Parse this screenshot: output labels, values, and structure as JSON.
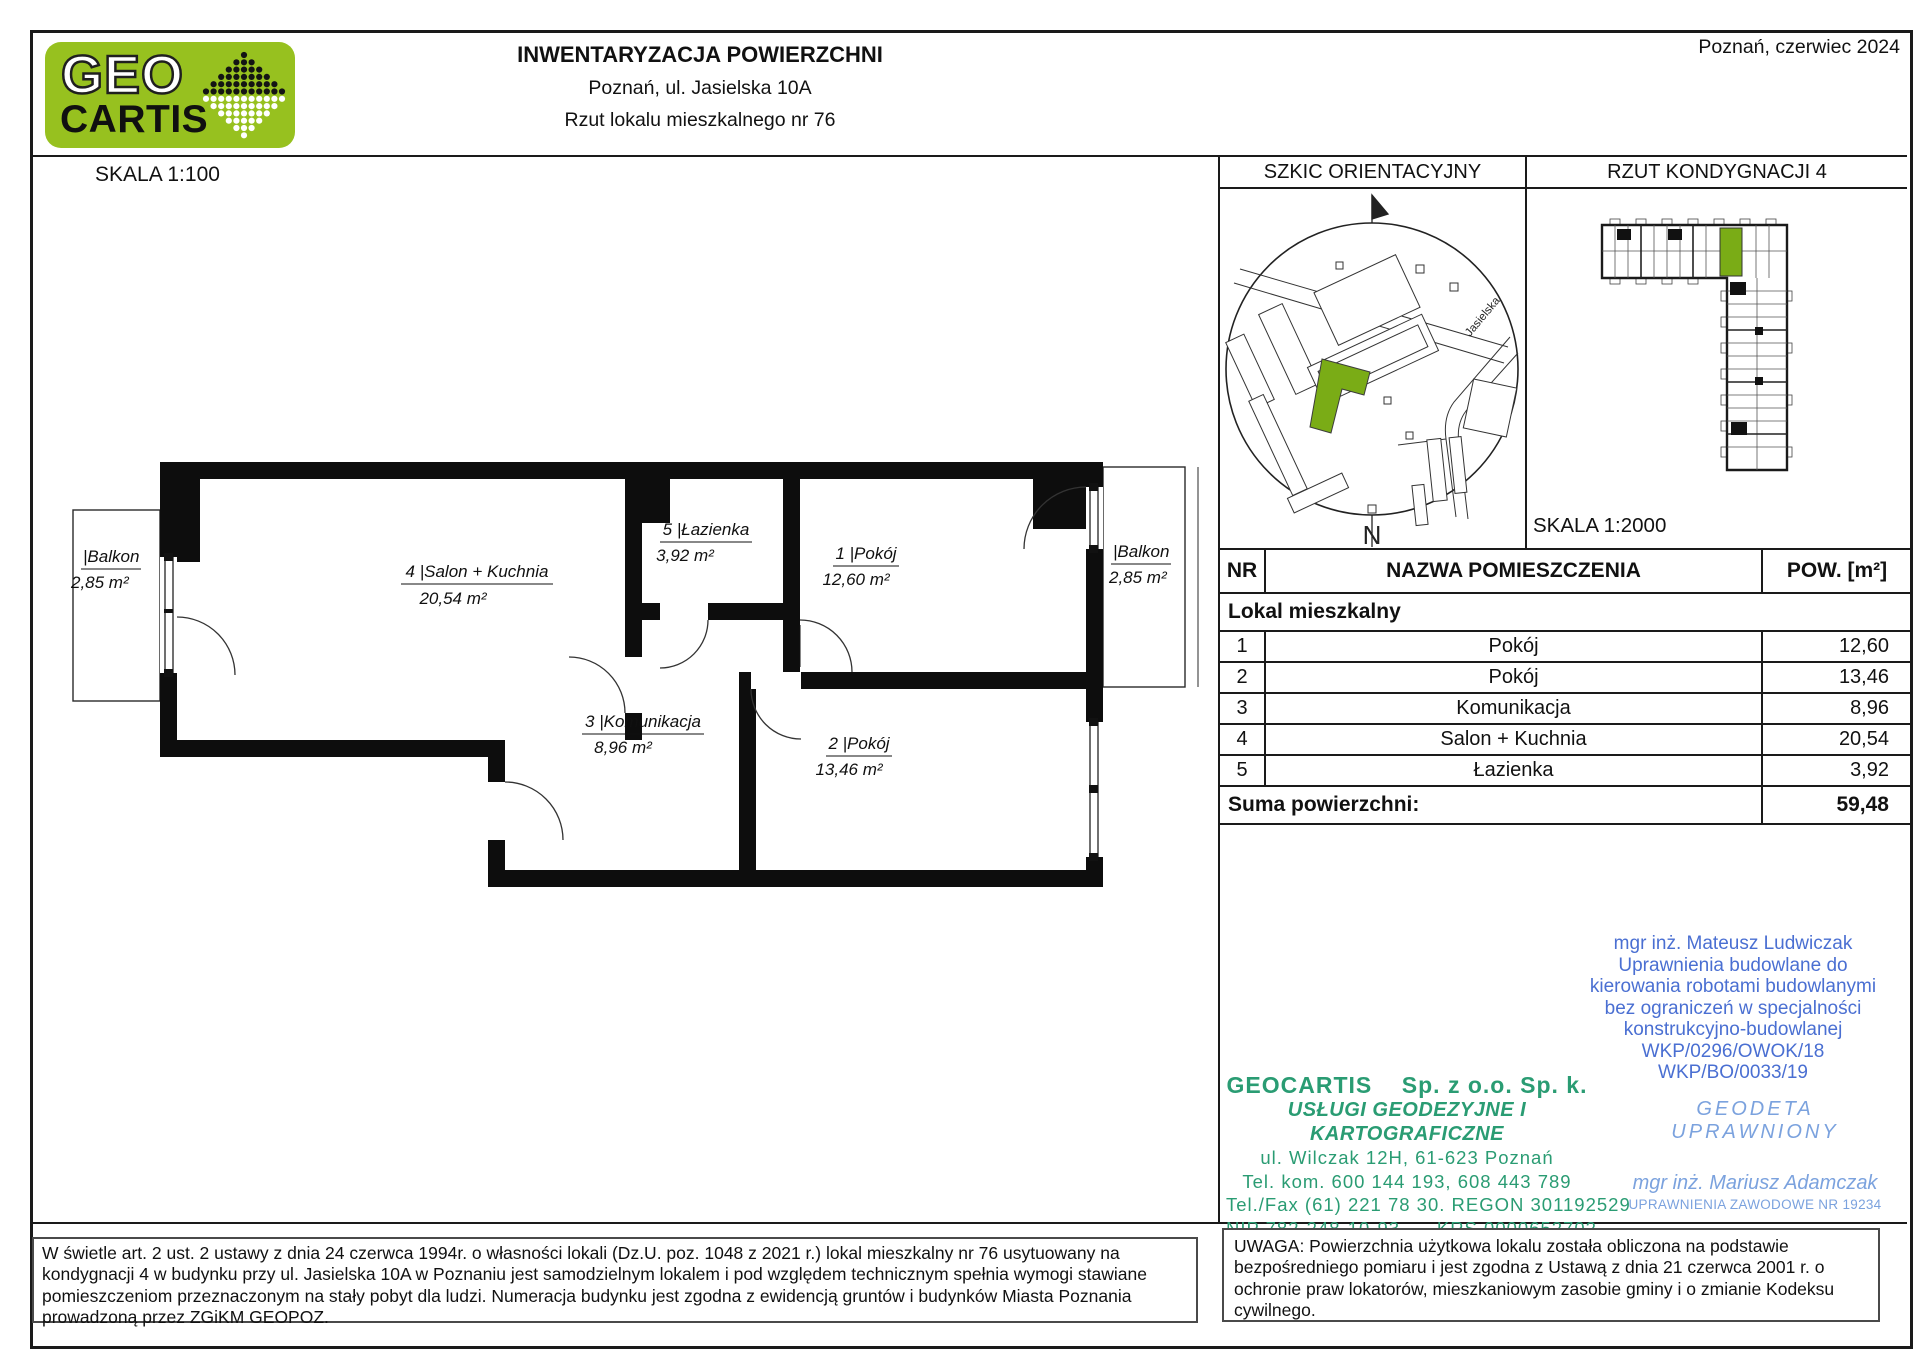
{
  "header": {
    "logo_top": "GEO",
    "logo_bottom": "CARTIS",
    "title": "INWENTARYZACJA POWIERZCHNI",
    "subtitle": "Poznań, ul. Jasielska 10A",
    "doc_type": "Rzut lokalu mieszkalnego nr 76",
    "date": "Poznań, czerwiec 2024"
  },
  "plan": {
    "scale_label": "SKALA 1:100",
    "rooms": {
      "salon": {
        "label": "4 |Salon + Kuchnia",
        "area": "20,54 m²"
      },
      "lazienka": {
        "label": "5 |Łazienka",
        "area": "3,92 m²"
      },
      "pokoj1": {
        "label": "1 |Pokój",
        "area": "12,60 m²"
      },
      "komunikacja": {
        "label": "3 |Komunikacja",
        "area": "8,96 m²"
      },
      "pokoj2": {
        "label": "2 |Pokój",
        "area": "13,46 m²"
      },
      "balkon_left": {
        "label": "|Balkon",
        "area": "2,85 m²"
      },
      "balkon_right": {
        "label": "|Balkon",
        "area": "2,85 m²"
      }
    }
  },
  "panels": {
    "sketch_title": "SZKIC ORIENTACYJNY",
    "floor_title": "RZUT KONDYGNACJI 4",
    "floor_scale": "SKALA 1:2000",
    "street": "Jasielska",
    "north": "N"
  },
  "table": {
    "headers": {
      "nr": "NR",
      "name": "NAZWA POMIESZCZENIA",
      "area": "POW. [m²]"
    },
    "group": "Lokal mieszkalny",
    "rows": [
      {
        "nr": "1",
        "name": "Pokój",
        "area": "12,60"
      },
      {
        "nr": "2",
        "name": "Pokój",
        "area": "13,46"
      },
      {
        "nr": "3",
        "name": "Komunikacja",
        "area": "8,96"
      },
      {
        "nr": "4",
        "name": "Salon + Kuchnia",
        "area": "20,54"
      },
      {
        "nr": "5",
        "name": "Łazienka",
        "area": "3,92"
      }
    ],
    "sum_label": "Suma powierzchni:",
    "sum_value": "59,48"
  },
  "stamps": {
    "engineer": {
      "lines": [
        "mgr inż. Mateusz Ludwiczak",
        "Uprawnienia budowlane do",
        "kierowania robotami budowlanymi",
        "bez ograniczeń w specjalności",
        "konstrukcyjno-budowlanej",
        "WKP/0296/OWOK/18",
        "WKP/BO/0033/19"
      ]
    },
    "company": {
      "name": "GEOCARTIS    Sp. z o.o. Sp. k.",
      "tagline": "USŁUGI GEODEZYJNE I KARTOGRAFICZNE",
      "lines": [
        "ul. Wilczak 12H, 61-623 Poznań",
        "Tel. kom. 600 144 193, 608 443 789",
        "Tel./Fax (61) 221 78 30. REGON 301192529",
        "NIP 782-248-10-93      KRS 0000652702"
      ]
    },
    "surveyor": {
      "title": "GEODETA UPRAWNIONY",
      "name": "mgr inż. Mariusz Adamczak",
      "license": "UPRAWNIENIA ZAWODOWE NR 19234"
    }
  },
  "footer": {
    "left": "W świetle art. 2 ust. 2 ustawy z dnia 24 czerwca 1994r. o własności lokali (Dz.U. poz. 1048 z 2021 r.) lokal mieszkalny nr 76 usytuowany na kondygnacji 4 w budynku przy ul. Jasielska 10A w Poznaniu jest samodzielnym lokalem i pod względem technicznym spełnia wymogi stawiane pomieszczeniom przeznaczonym na stały pobyt dla ludzi. Numeracja budynku jest zgodna z ewidencją gruntów i budynków Miasta Poznania prowadzoną przez ZGiKM GEOPOZ.",
    "right": "UWAGA: Powierzchnia użytkowa lokalu została obliczona na podstawie bezpośredniego pomiaru i jest zgodna z Ustawą z dnia 21 czerwca 2001 r. o ochronie praw lokatorów, mieszkaniowym zasobie gminy i o zmianie Kodeksu cywilnego."
  },
  "colors": {
    "logo_green": "#97c11f",
    "highlight_green": "#7aac16",
    "company_teal": "#2a9c73",
    "engineer_blue": "#4a6fd2",
    "surveyor_blue": "#7ba2de"
  }
}
